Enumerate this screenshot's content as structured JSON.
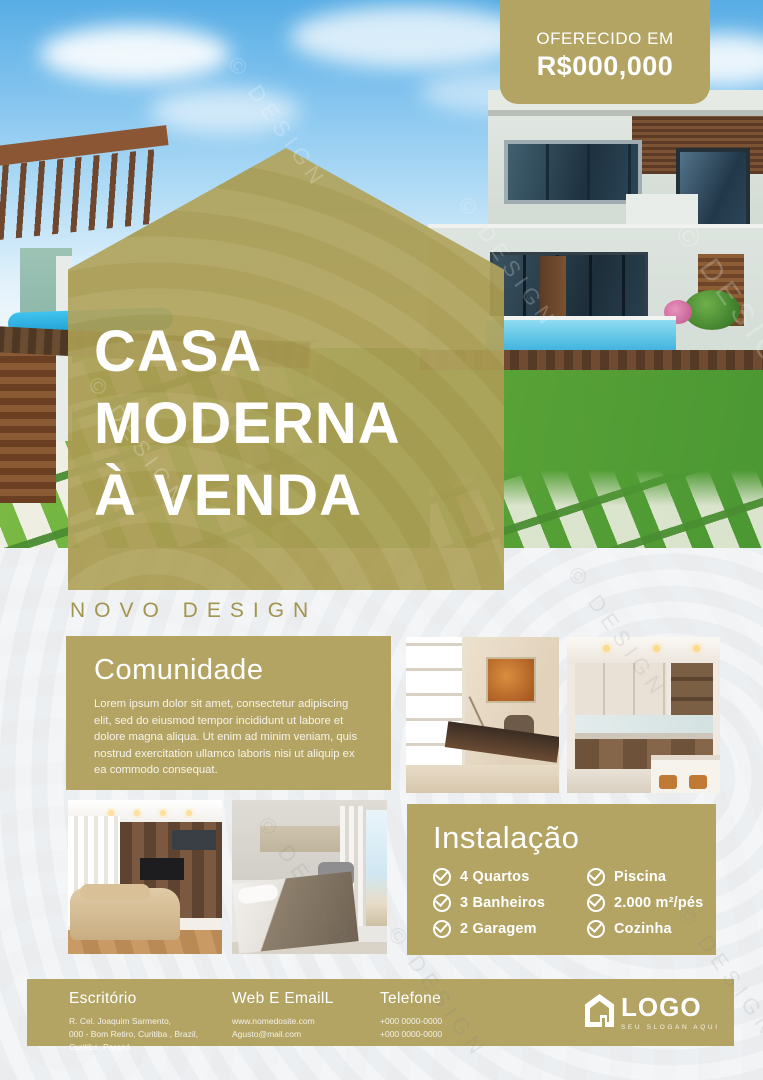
{
  "accent_color": "#b3a464",
  "background_color": "#eef0f2",
  "price_badge": {
    "label": "OFERECIDO EM",
    "value": "R$000,000"
  },
  "hero_title": {
    "line1": "CASA",
    "line2": "MODERNA",
    "line3": "À VENDA"
  },
  "section_label": "NOVO DESIGN",
  "comunidade": {
    "title": "Comunidade",
    "body": "Lorem ipsum dolor sit amet, consectetur adipiscing elit, sed do eiusmod tempor incididunt ut labore et dolore magna aliqua. Ut enim ad minim veniam, quis nostrud exercitation ullamco laboris nisi ut aliquip ex ea commodo consequat."
  },
  "instalacao": {
    "title": "Instalação",
    "items_left": [
      "4 Quartos",
      "3 Banheiros",
      "2 Garagem"
    ],
    "items_right": [
      "Piscina",
      "2.000 m²/pés",
      "Cozinha"
    ]
  },
  "footer": {
    "office": {
      "title": "Escritório",
      "lines": [
        "R. Cel. Joaquim Sarmento,",
        "000 - Bom Retiro, Curitiba , Brazil,",
        "Curitiba, Paraná"
      ]
    },
    "web": {
      "title": "Web E EmailL",
      "lines": [
        "www.nomedosite.com",
        "Agusto@mail.com"
      ]
    },
    "phone": {
      "title": "Telefone",
      "lines": [
        "+000 0000-0000",
        "+000 0000-0000"
      ]
    },
    "logo": {
      "name": "LOGO",
      "slogan": "SEU SLOGAN AQUI"
    }
  },
  "watermark": {
    "text": "© DESIGN"
  }
}
